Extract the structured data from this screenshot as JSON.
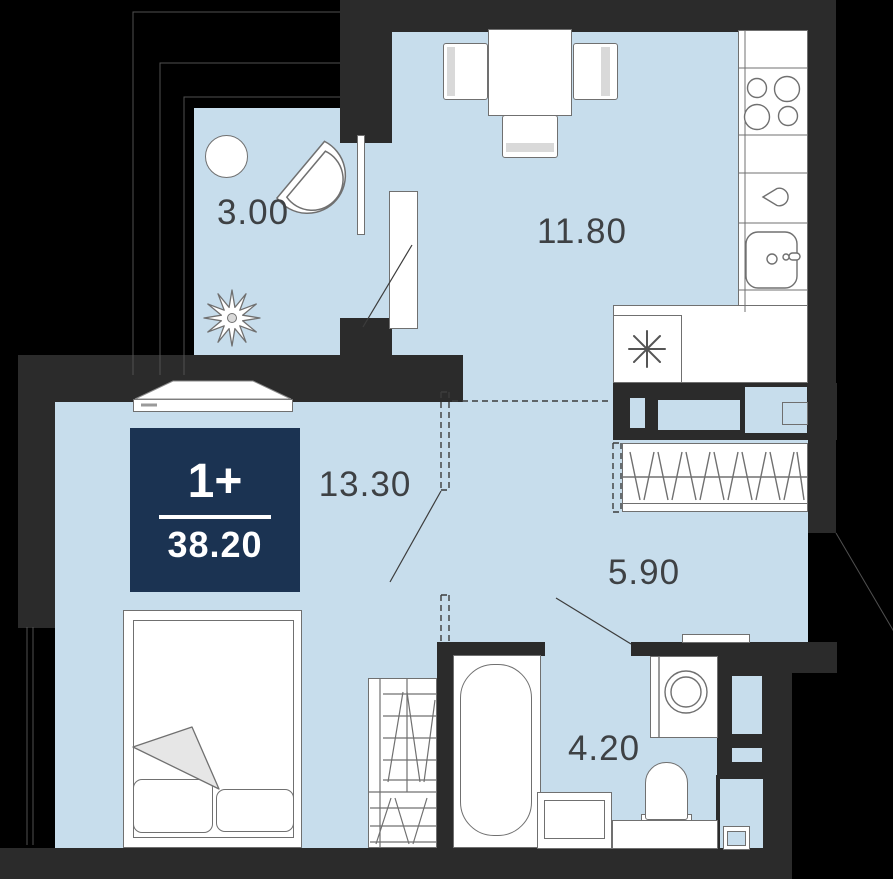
{
  "plan": {
    "badge": {
      "type_label": "1+",
      "total_area": "38.20"
    },
    "areas": {
      "balcony": "3.00",
      "kitchen_living": "11.80",
      "bedroom": "13.30",
      "hallway": "5.90",
      "bathroom": "4.20"
    },
    "colors": {
      "background": "#000000",
      "wall": "#2b2b2b",
      "floor": "#c7ddec",
      "furniture_fill": "#ffffff",
      "furniture_outline": "#707070",
      "badge_bg": "#1b3352",
      "badge_text": "#ffffff",
      "label_text": "#3e4144"
    },
    "furniture": [
      "round-table",
      "fan-chair",
      "plant",
      "dining-table",
      "chairs",
      "stove",
      "kitchen-sink",
      "fridge-snowflake",
      "hall-wardrobe",
      "bed",
      "bedroom-wardrobe",
      "bathtub",
      "washbasin",
      "toilet",
      "washing-machine"
    ]
  }
}
